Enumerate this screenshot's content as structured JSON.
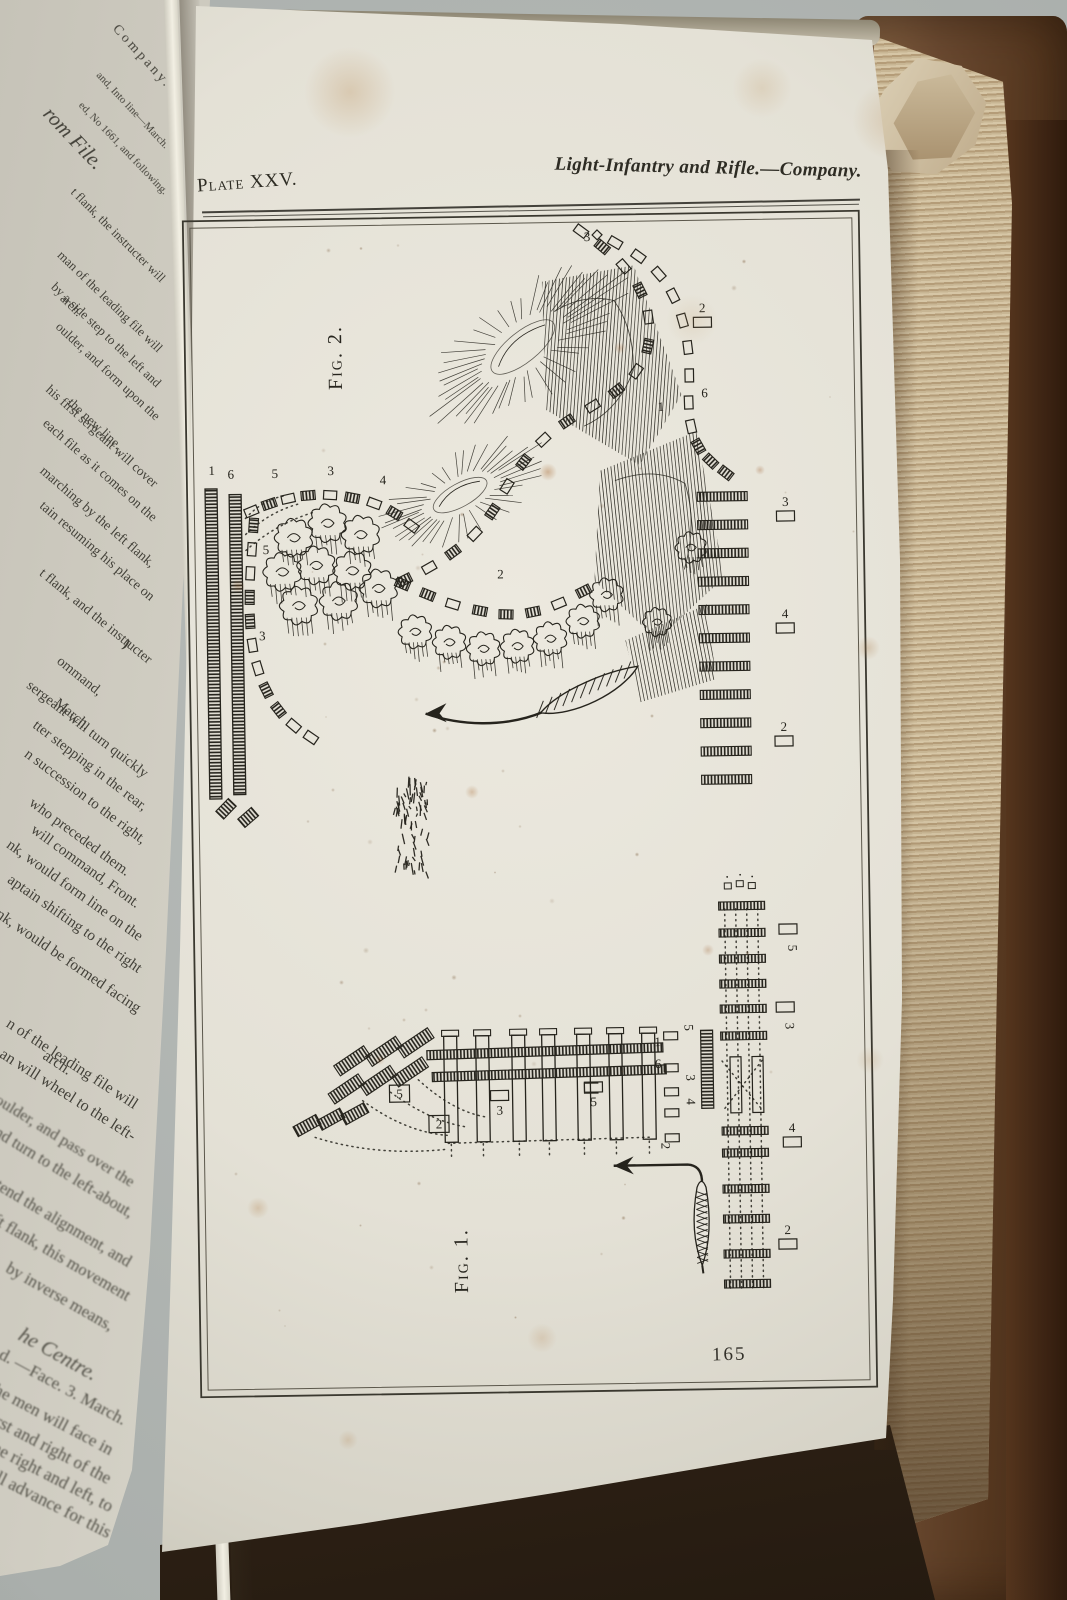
{
  "photo": {
    "backdrop_color": "#aab0ad",
    "cover_color": "#6b4a31",
    "page_edge_color": "#c8b694",
    "paper_color": "#e6e3d8",
    "ink_color": "#26241d"
  },
  "header": {
    "plate_label": "Plate XXV.",
    "title": "Light-Infantry and Rifle.—Company."
  },
  "page_number": "165",
  "figures": {
    "fig2": "Fig. 2.",
    "fig1": "Fig. 1."
  },
  "left_page_lines": [
    {
      "t": "Company.",
      "y": 88,
      "s": 14,
      "sp": 3
    },
    {
      "t": "and, Into line—March.",
      "y": 150,
      "s": 11
    },
    {
      "t": "ed, No 1661, and following.",
      "y": 196,
      "s": 11
    },
    {
      "t": "rom File.",
      "y": 163,
      "x": 100,
      "s": 21,
      "i": 1
    },
    {
      "t": "t flank, the instructer will",
      "y": 282
    },
    {
      "t": "arch.",
      "y": 316,
      "x": 80
    },
    {
      "t": "man of the leading file will",
      "y": 352
    },
    {
      "t": "by a side step to the left and",
      "y": 386
    },
    {
      "t": "oulder, and form upon the",
      "y": 419
    },
    {
      "t": "the new line.",
      "y": 448,
      "x": 120
    },
    {
      "t": "his first sergeant will cover",
      "y": 486
    },
    {
      "t": "each file as it comes on the",
      "y": 520
    },
    {
      "t": "marching by the left flank,",
      "y": 566
    },
    {
      "t": "tain resuming his place on",
      "y": 600
    },
    {
      "t": "t flank, and the instructer",
      "y": 662
    },
    {
      "t": "ommand,",
      "y": 694,
      "x": 100
    },
    {
      "t": "March.",
      "y": 728,
      "x": 88
    },
    {
      "t": "sergeant will turn quickly",
      "y": 776
    },
    {
      "t": "tter stepping in the rear,",
      "y": 809
    },
    {
      "t": "n succession to the right,",
      "y": 842
    },
    {
      "t": "who preceded them.",
      "y": 874,
      "x": 128
    },
    {
      "t": "will command, Front.",
      "y": 906,
      "x": 138
    },
    {
      "t": "nk, would form line on the",
      "y": 938
    },
    {
      "t": "aptain shifting to the right",
      "y": 970
    },
    {
      "t": "nk, would be formed facing",
      "y": 1010
    },
    {
      "t": "arch.",
      "y": 1072,
      "x": 70
    },
    {
      "t": "n of the leading file will",
      "y": 1106
    },
    {
      "t": "an will wheel to the left-",
      "y": 1138
    },
    {
      "t": "oulder, and pass over the",
      "y": 1183
    },
    {
      "t": "and turn to the left-about,",
      "y": 1213
    },
    {
      "t": "intend the alignment, and",
      "y": 1262
    },
    {
      "t": "left flank, this movement",
      "y": 1296
    },
    {
      "t": "by inverse means,",
      "y": 1326,
      "x": 112
    },
    {
      "t": "he Centre.",
      "y": 1372,
      "x": 96,
      "s": 21,
      "i": 1
    },
    {
      "t": "d.  —Face.  3. March.",
      "y": 1420
    },
    {
      "t": "the men will face in",
      "y": 1450,
      "x": 112
    },
    {
      "t": "first and right of the",
      "y": 1478,
      "x": 110
    },
    {
      "t": "to the right and left, to",
      "y": 1506,
      "x": 112
    },
    {
      "t": "will advance for this",
      "y": 1532,
      "x": 110
    }
  ],
  "plate_annotations": {
    "fig2": [
      {
        "t": "1",
        "x": 27,
        "y": 258
      },
      {
        "t": "6",
        "x": 46,
        "y": 262
      },
      {
        "t": "5",
        "x": 90,
        "y": 262
      },
      {
        "t": "3",
        "x": 146,
        "y": 260
      },
      {
        "t": "4",
        "x": 198,
        "y": 270
      },
      {
        "t": "5",
        "x": 80,
        "y": 338
      },
      {
        "t": "3",
        "x": 75,
        "y": 424
      },
      {
        "t": "2",
        "x": 314,
        "y": 366
      },
      {
        "t": "3",
        "x": 406,
        "y": 30
      },
      {
        "t": "2",
        "x": 520,
        "y": 103,
        "r": "below"
      },
      {
        "t": "6",
        "x": 521,
        "y": 188
      },
      {
        "t": "1",
        "x": 477,
        "y": 201
      },
      {
        "t": "3",
        "x": 600,
        "y": 298,
        "r": "below"
      },
      {
        "t": "4",
        "x": 598,
        "y": 410,
        "r": "below"
      },
      {
        "t": "2",
        "x": 595,
        "y": 523,
        "r": "below"
      }
    ],
    "fig1": [
      {
        "t": "5",
        "x": 205,
        "y": 884,
        "r": "box"
      },
      {
        "t": "2",
        "x": 244,
        "y": 915,
        "r": "box"
      },
      {
        "t": "3",
        "x": 305,
        "y": 902,
        "r": "above"
      },
      {
        "t": "5",
        "x": 399,
        "y": 895,
        "r": "above"
      },
      {
        "t": "5",
        "x": 491,
        "y": 818,
        "rot": 90
      },
      {
        "t": "1",
        "x": 464,
        "y": 836
      },
      {
        "t": "6",
        "x": 464,
        "y": 858
      },
      {
        "t": "3",
        "x": 492,
        "y": 868,
        "rot": 90
      },
      {
        "t": "4",
        "x": 492,
        "y": 892,
        "rot": 90
      },
      {
        "t": "2",
        "x": 466,
        "y": 936,
        "rot": 90
      },
      {
        "t": "5",
        "x": 596,
        "y": 740,
        "r": "above",
        "rot": 90
      },
      {
        "t": "3",
        "x": 592,
        "y": 818,
        "r": "above",
        "rot": 90
      },
      {
        "t": "4",
        "x": 597,
        "y": 924,
        "r": "below"
      },
      {
        "t": "2",
        "x": 591,
        "y": 1026,
        "r": "below"
      }
    ]
  }
}
